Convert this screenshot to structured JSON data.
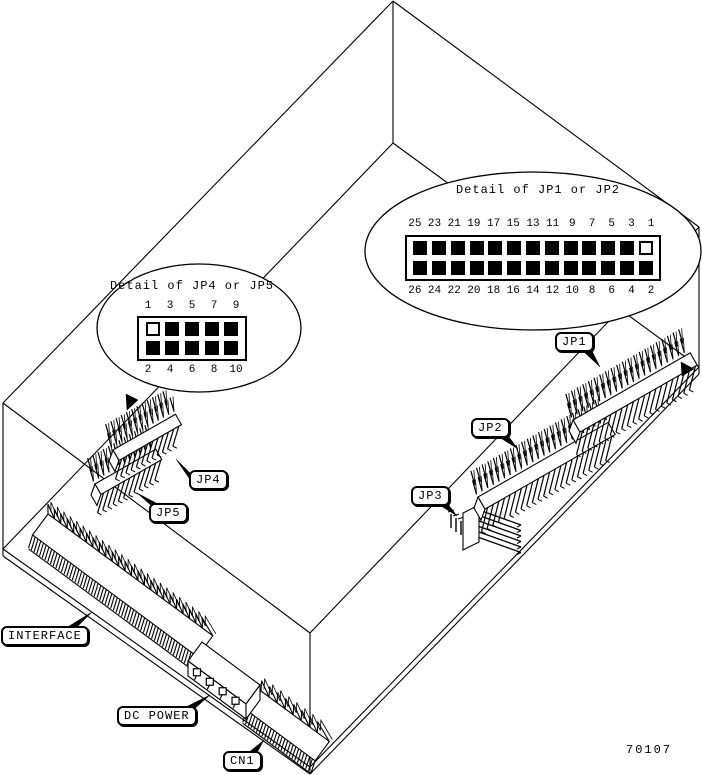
{
  "figure": {
    "number": "70107"
  },
  "details": {
    "jp12": {
      "title": "Detail of JP1 or JP2",
      "top_pins": [
        "25",
        "23",
        "21",
        "19",
        "17",
        "15",
        "13",
        "11",
        "9",
        "7",
        "5",
        "3",
        "1"
      ],
      "bottom_pins": [
        "26",
        "24",
        "22",
        "20",
        "18",
        "16",
        "14",
        "12",
        "10",
        "8",
        "6",
        "4",
        "2"
      ],
      "open_pin": "1"
    },
    "jp45": {
      "title": "Detail of JP4 or JP5",
      "top_pins": [
        "1",
        "3",
        "5",
        "7",
        "9"
      ],
      "bottom_pins": [
        "2",
        "4",
        "6",
        "8",
        "10"
      ],
      "open_pin": "1"
    }
  },
  "callouts": {
    "jp1": "JP1",
    "jp2": "JP2",
    "jp3": "JP3",
    "jp4": "JP4",
    "jp5": "JP5",
    "interface": "INTERFACE",
    "dc_power": "DC POWER",
    "cn1": "CN1"
  },
  "colors": {
    "ink": "#000000",
    "paper": "#ffffff"
  }
}
